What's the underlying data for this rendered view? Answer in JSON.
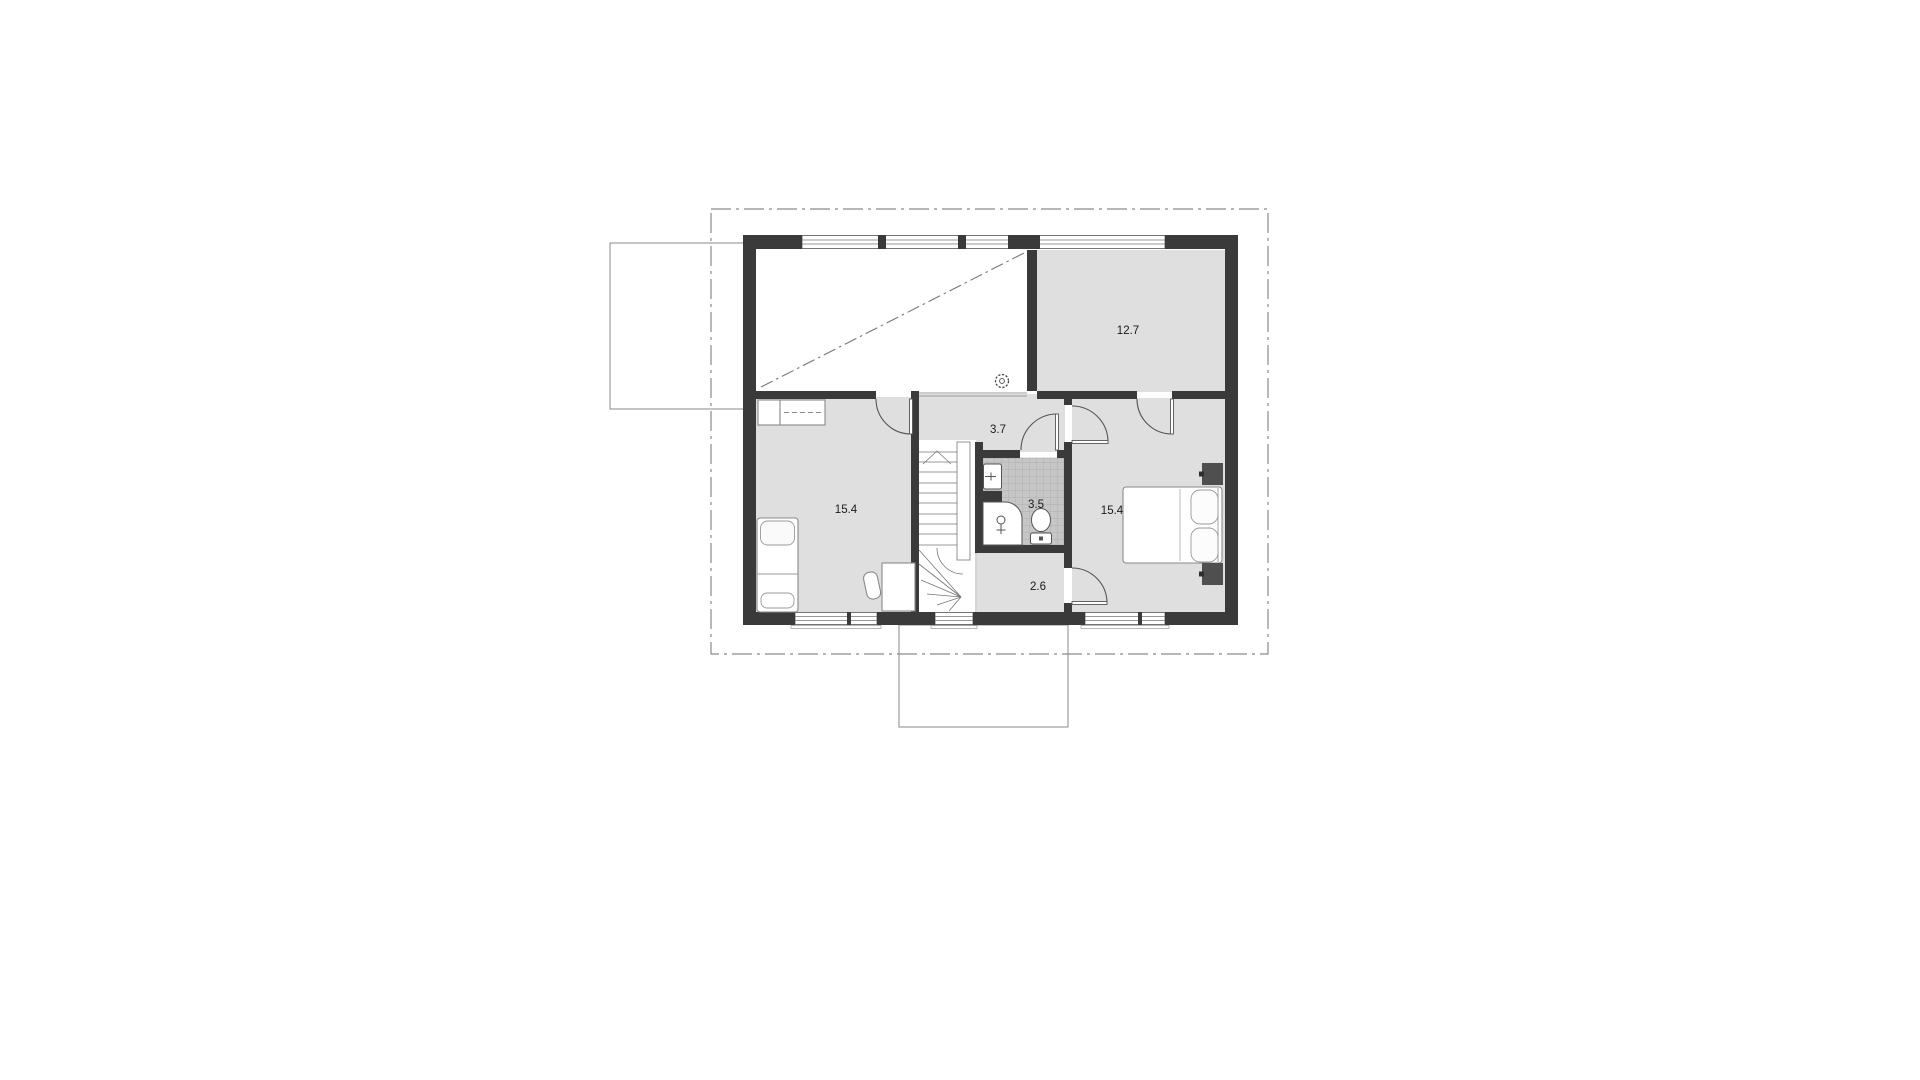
{
  "rooms": {
    "dressing": {
      "area": "12.7"
    },
    "hall": {
      "area": "3.7"
    },
    "bedroom_left": {
      "area": "15.4"
    },
    "bathroom": {
      "area": "3.5"
    },
    "bedroom_right": {
      "area": "15.4"
    },
    "hall_lower": {
      "area": "2.6"
    }
  },
  "icons": {
    "ceiling_fan": "dashed-circle-vent-symbol",
    "stair_direction": "chevron-up-arrow",
    "sink": "washbasin-with-faucet",
    "shower": "shower-head-symbol",
    "toilet": "wc-bowl-and-cistern"
  },
  "colors": {
    "wall": "#3a3a3a",
    "floor": "#dfdfdf",
    "tile_floor": "#c6c6c6",
    "tile_grid": "#a8a8a8",
    "outline": "#8a8a8a",
    "label": "#1a1a1a"
  }
}
